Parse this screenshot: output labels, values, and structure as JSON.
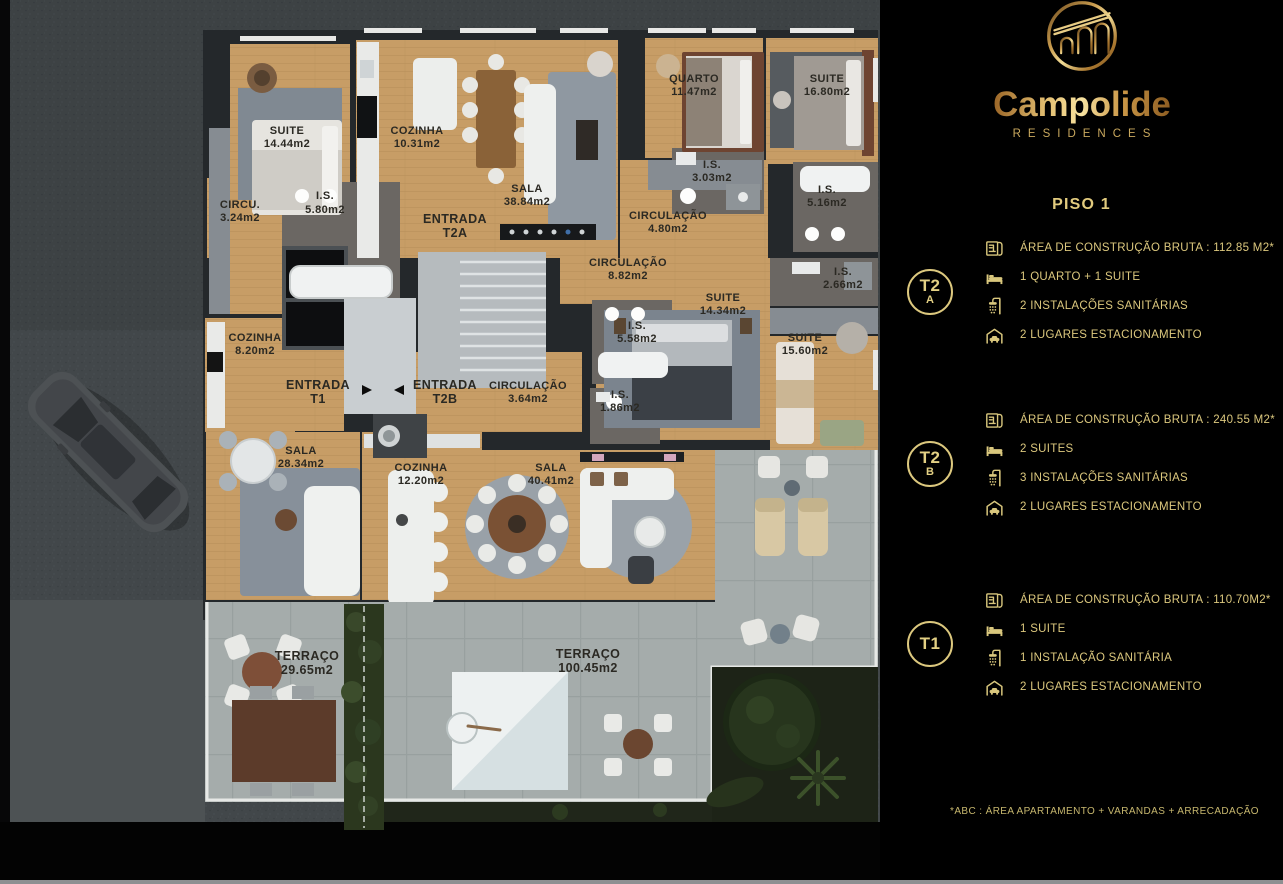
{
  "brand": {
    "name": "Campolide",
    "subtitle": "RESIDENCES"
  },
  "panel": {
    "title": "PISO 1",
    "footnote": "*ABC :  ÁREA APARTAMENTO + VARANDAS + ARRECADAÇÃO",
    "accent_gold": "#dcc87e"
  },
  "units": [
    {
      "id": "T2A",
      "badge_top": "T2",
      "badge_bottom": "A",
      "specs": [
        {
          "icon": "blueprint-icon",
          "text": "ÁREA DE CONSTRUÇÃO BRUTA :  112.85 M2*"
        },
        {
          "icon": "bed-icon",
          "text": "1 QUARTO + 1 SUITE"
        },
        {
          "icon": "shower-icon",
          "text": "2 INSTALAÇÕES SANITÁRIAS"
        },
        {
          "icon": "garage-icon",
          "text": "2 LUGARES ESTACIONAMENTO"
        }
      ]
    },
    {
      "id": "T2B",
      "badge_top": "T2",
      "badge_bottom": "B",
      "specs": [
        {
          "icon": "blueprint-icon",
          "text": "ÁREA DE CONSTRUÇÃO BRUTA :  240.55 M2*"
        },
        {
          "icon": "bed-icon",
          "text": "2 SUITES"
        },
        {
          "icon": "shower-icon",
          "text": "3 INSTALAÇÕES SANITÁRIAS"
        },
        {
          "icon": "garage-icon",
          "text": "2 LUGARES ESTACIONAMENTO"
        }
      ]
    },
    {
      "id": "T1",
      "badge_top": "T1",
      "badge_bottom": "",
      "specs": [
        {
          "icon": "blueprint-icon",
          "text": "ÁREA DE CONSTRUÇÃO BRUTA :  110.70M2*"
        },
        {
          "icon": "bed-icon",
          "text": "1 SUITE"
        },
        {
          "icon": "shower-icon",
          "text": "1 INSTALAÇÃO SANITÁRIA"
        },
        {
          "icon": "garage-icon",
          "text": "2 LUGARES ESTACIONAMENTO"
        }
      ]
    }
  ],
  "plan": {
    "rooms": [
      {
        "name": "SUITE",
        "area": "14.44m2"
      },
      {
        "name": "COZINHA",
        "area": "10.31m2"
      },
      {
        "name": "SALA",
        "area": "38.84m2"
      },
      {
        "name": "ENTRADA",
        "area": "T2A"
      },
      {
        "name": "QUARTO",
        "area": "11.47m2"
      },
      {
        "name": "SUITE",
        "area": "16.80m2"
      },
      {
        "name": "I.S.",
        "area": "3.03m2"
      },
      {
        "name": "I.S.",
        "area": "5.16m2"
      },
      {
        "name": "CIRCULAÇÃO",
        "area": "4.80m2"
      },
      {
        "name": "I.S.",
        "area": "5.80m2"
      },
      {
        "name": "CIRCU.",
        "area": "3.24m2"
      },
      {
        "name": "CIRCULAÇÃO",
        "area": "8.82m2"
      },
      {
        "name": "I.S.",
        "area": "2.66m2"
      },
      {
        "name": "SUITE",
        "area": "14.34m2"
      },
      {
        "name": "I.S.",
        "area": "5.58m2"
      },
      {
        "name": "SUITE",
        "area": "15.60m2"
      },
      {
        "name": "COZINHA",
        "area": "8.20m2"
      },
      {
        "name": "ENTRADA",
        "area": "T1"
      },
      {
        "name": "ENTRADA",
        "area": "T2B"
      },
      {
        "name": "CIRCULAÇÃO",
        "area": "3.64m2"
      },
      {
        "name": "I.S.",
        "area": "1.86m2"
      },
      {
        "name": "SALA",
        "area": "28.34m2"
      },
      {
        "name": "COZINHA",
        "area": "12.20m2"
      },
      {
        "name": "SALA",
        "area": "40.41m2"
      },
      {
        "name": "TERRAÇO",
        "area": "29.65m2"
      },
      {
        "name": "TERRAÇO",
        "area": "100.45m2"
      }
    ]
  }
}
